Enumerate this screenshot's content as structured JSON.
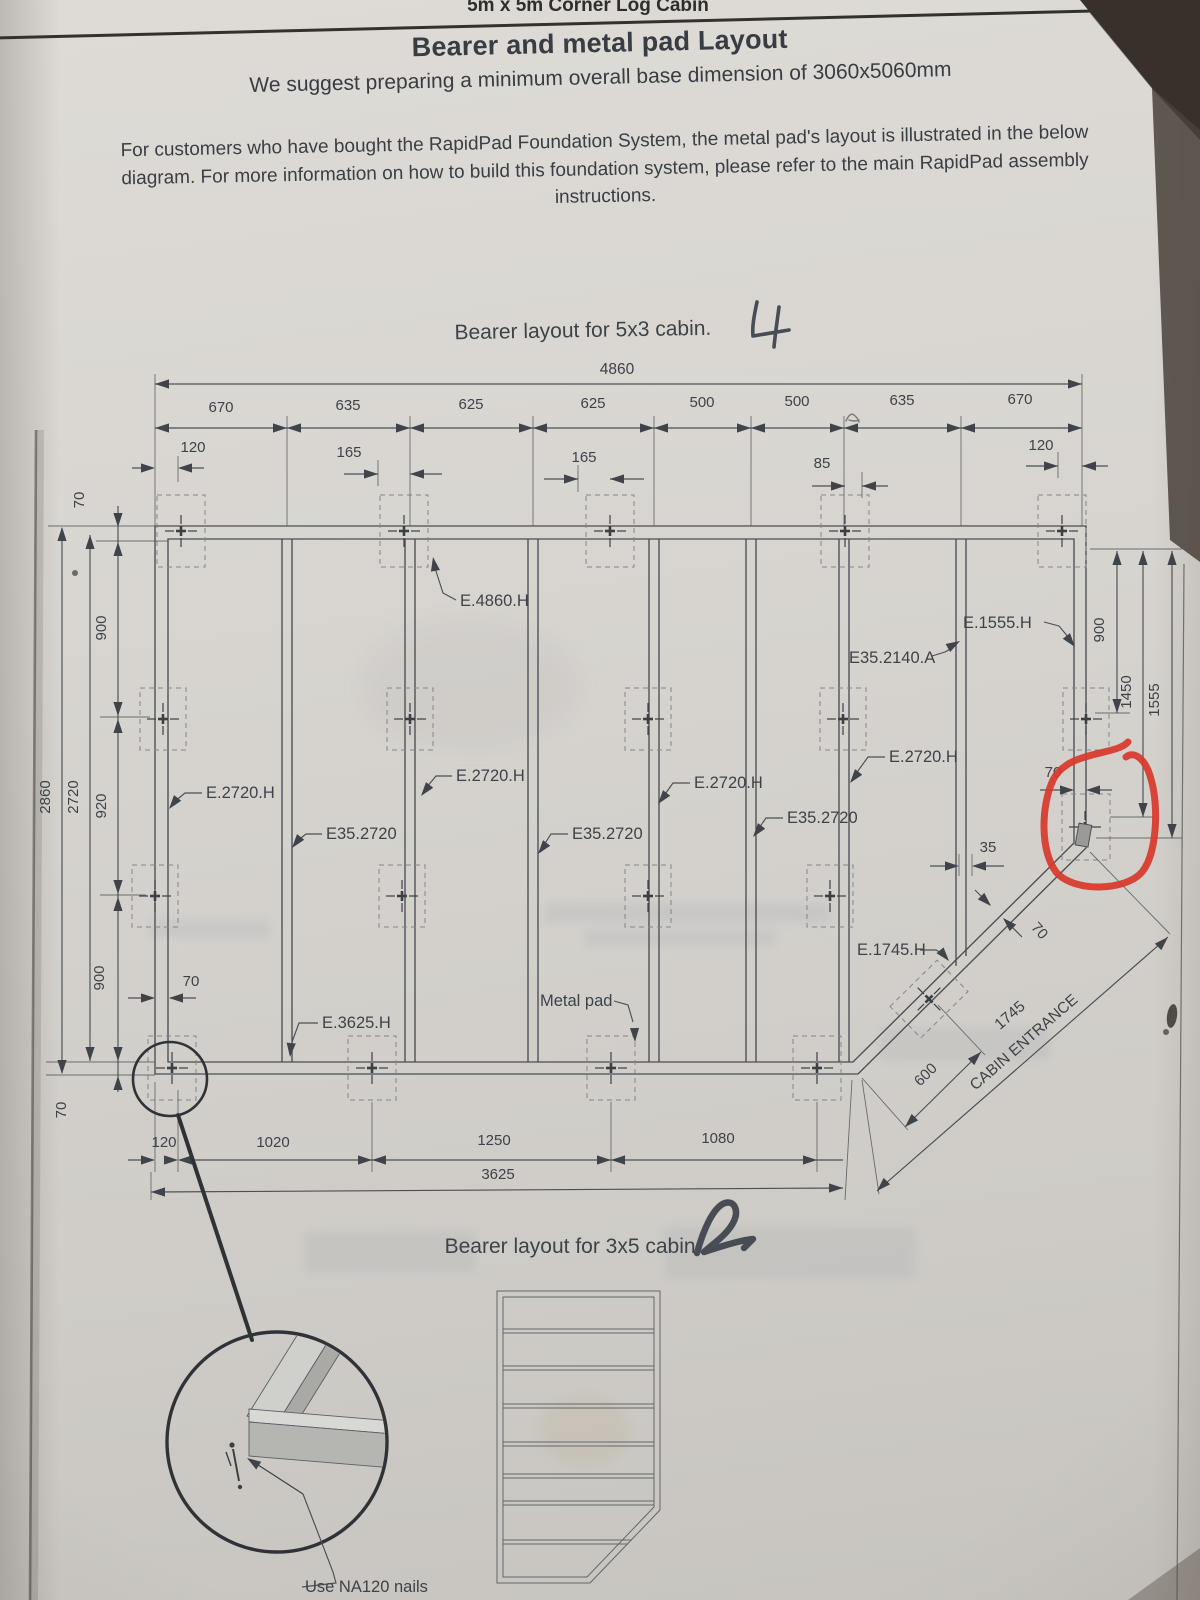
{
  "colors": {
    "paper": "#d7d4cf",
    "ink": "#3e4249",
    "red_annotation": "#d8382b"
  },
  "header": {
    "clipped_doc_title": "5m x 5m Corner Log Cabin",
    "title": "Bearer and metal pad Layout",
    "subtitle": "We suggest preparing a minimum overall base dimension of 3060x5060mm",
    "note": "For customers who have bought the RapidPad Foundation System, the metal pad's layout is illustrated in the below diagram. For more information on how to build this foundation system, please refer to the main RapidPad assembly instructions."
  },
  "diagram": {
    "caption": "Bearer layout for 5x3 cabin.",
    "handwritten_mark": "4",
    "overall_width": "4860",
    "top_dims": [
      "670",
      "635",
      "625",
      "625",
      "500",
      "500",
      "635",
      "670"
    ],
    "offset_dims": [
      "120",
      "165",
      "165",
      "85",
      "120"
    ],
    "left": {
      "overall": "2860",
      "inner": "2720",
      "segments": [
        "70",
        "900",
        "920",
        "900",
        "70"
      ]
    },
    "right": {
      "segments": [
        "900",
        "1450",
        "1555"
      ]
    },
    "labels": {
      "top_bearer": "E.4860.H",
      "right_top": "E.1555.H",
      "corner_pad": "E35.2140.A",
      "vertical_bearer": "E.2720.H",
      "pad_column": "E35.2720",
      "diagonal_bearer": "E.1745.H",
      "bottom_bearer": "E.3625.H",
      "metal_pad": "Metal pad",
      "bearer_width": "70",
      "pad_offset": "35",
      "entrance_width": "600",
      "entrance_length": "1745",
      "entrance_label": "CABIN ENTRANCE"
    },
    "bottom_dims": [
      "120",
      "1020",
      "1250",
      "1080"
    ],
    "bottom_total": "3625"
  },
  "caption_3x5": {
    "caption": "Bearer layout for 3x5 cabin.",
    "handwritten_mark": "2"
  },
  "detail": {
    "note": "Use NA120 nails"
  }
}
